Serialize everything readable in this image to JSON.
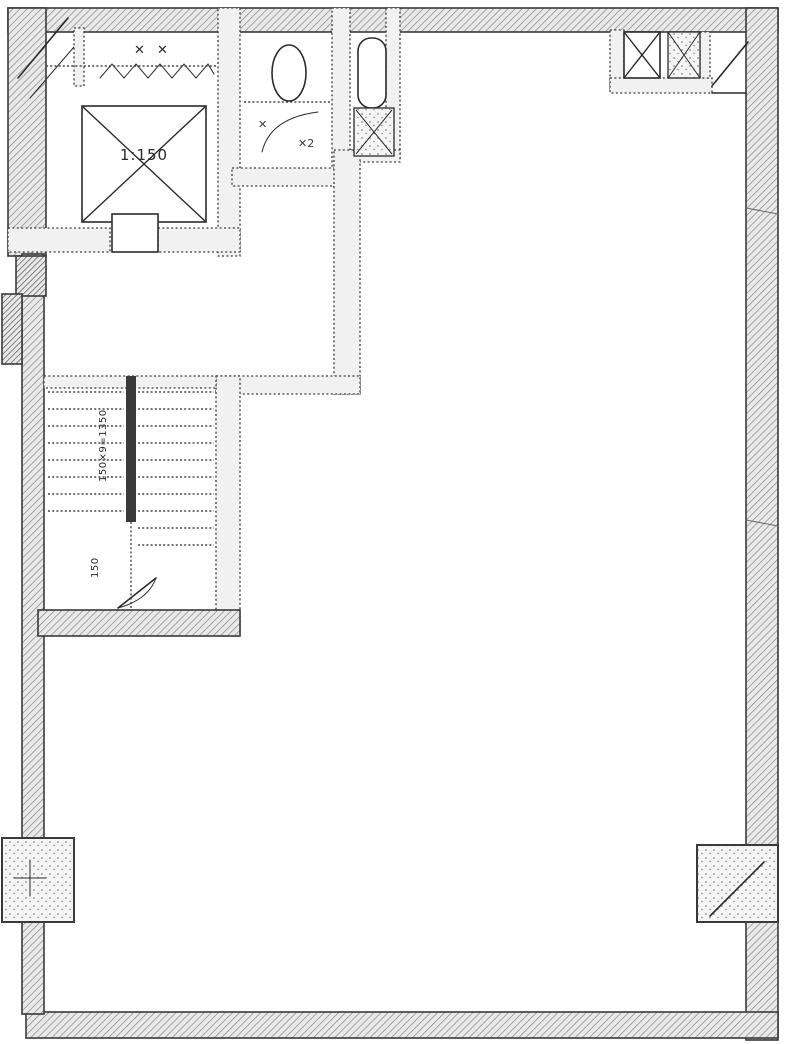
{
  "plan": {
    "kind": "scanned-floor-plan",
    "annotations": {
      "shaft_scale_label": "1:150",
      "stair_run_label": "150×9=1350",
      "stair_landing_label": "150",
      "machine_room_marks": "✕ ✕",
      "bath_mark_a": "✕",
      "bath_mark_b": "✕2"
    },
    "colors": {
      "ink": "#2b2b2b",
      "wall-line": "#3a3a3a",
      "wall-fill": "#e9e9e9",
      "hatch-line": "#8d8d8d",
      "stipple-dot": "#8a8a8a",
      "paper": "#ffffff"
    }
  }
}
